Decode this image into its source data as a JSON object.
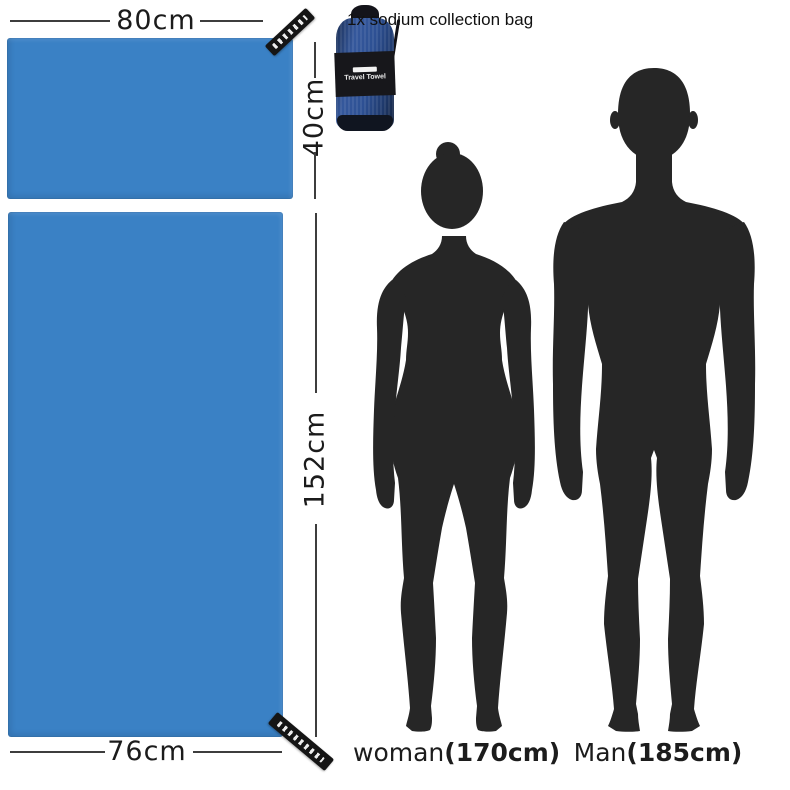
{
  "colors": {
    "towel_blue": "#3a81c5",
    "silhouette_dark": "#262626",
    "dimension_line": "#3d3d3d",
    "bag_blue": "#2d5093",
    "bag_band_black": "#17171b"
  },
  "towels": {
    "small": {
      "width_label": "80cm",
      "height_label": "40cm"
    },
    "large": {
      "height_label": "152cm",
      "width_label": "76cm"
    }
  },
  "bag": {
    "note": "1x sodium collection bag",
    "band_label": "Travel Towel"
  },
  "figures": {
    "woman": {
      "name": "woman",
      "size": "(170cm)"
    },
    "man": {
      "name": "Man",
      "size": "(185cm)"
    }
  }
}
